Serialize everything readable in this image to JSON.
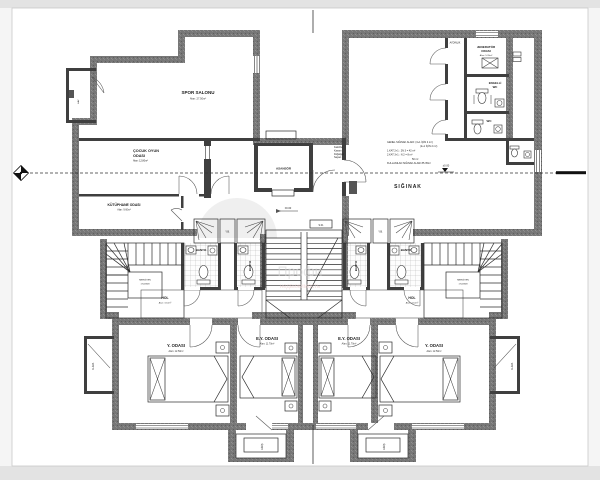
{
  "rooms": {
    "gym": {
      "name": "SPOR SALONU",
      "area": "Alan: 27.50m²"
    },
    "playroom": {
      "name_line1": "ÇOCUK OYUN",
      "name_line2": "ODASI",
      "area": "Alan: 12.80m²"
    },
    "library": {
      "name": "KÜTÜPHANE ODASI",
      "area": "Alan: 9.60m²"
    },
    "elevator": {
      "name": "ASANSÖR"
    },
    "generator": {
      "name_line1": "JENERATÖR",
      "name_line2": "ODASI",
      "area": "Alan: 5.20m²"
    },
    "accessible_wc": {
      "name_line1": "ENGELLİ",
      "name_line2": "WC"
    },
    "wc": {
      "name": "WC"
    },
    "shelter": {
      "name": "SIĞINAK"
    },
    "bathroom": {
      "name": "BANYO"
    },
    "hall": {
      "name": "HOL",
      "area": "Alan: 3.10m²"
    },
    "bedroom": {
      "name": "Y. ODASI",
      "area": "Alan: 12.50m²"
    },
    "master_bedroom": {
      "name": "E.Y. ODASI",
      "area": "Alan: 11.70m²"
    },
    "duct": {
      "name": "Y.B."
    },
    "entry": {
      "name": "GİRİŞ"
    },
    "ac": {
      "name": "KLİMA"
    },
    "shaft": {
      "name": "HAV."
    },
    "lightwell": {
      "name": "AYDINLIK"
    }
  },
  "notes": {
    "shelter_calc": [
      "GENEL SIĞINAK ALANI: (3+1 İÇİN 4 m²)",
      "(2+1 İÇİN 2 m²)",
      "1.KAT 2+1 : 2N 3 = 42 m²",
      "2.KAT 3+1 : N 2 = 8 m²",
      "50 m²",
      "KULLANILAN SIĞINAK ALANI 85.35m²"
    ],
    "boiler": [
      "Kalorifer",
      "Kazanı",
      "Doğalgaz",
      "Sayacı"
    ]
  },
  "markers": {
    "level_zero": "±0.00",
    "stair_label": "S.01",
    "winding_line1": "MERDİVEN",
    "winding_line2": "17x18/28"
  },
  "watermark": {
    "text1": "Профи",
    "text2": "недвижимость"
  },
  "colors": {
    "wall": "#777777",
    "paper": "#ffffff",
    "band": "#e3e3e3",
    "tile_line": "#adadad"
  }
}
